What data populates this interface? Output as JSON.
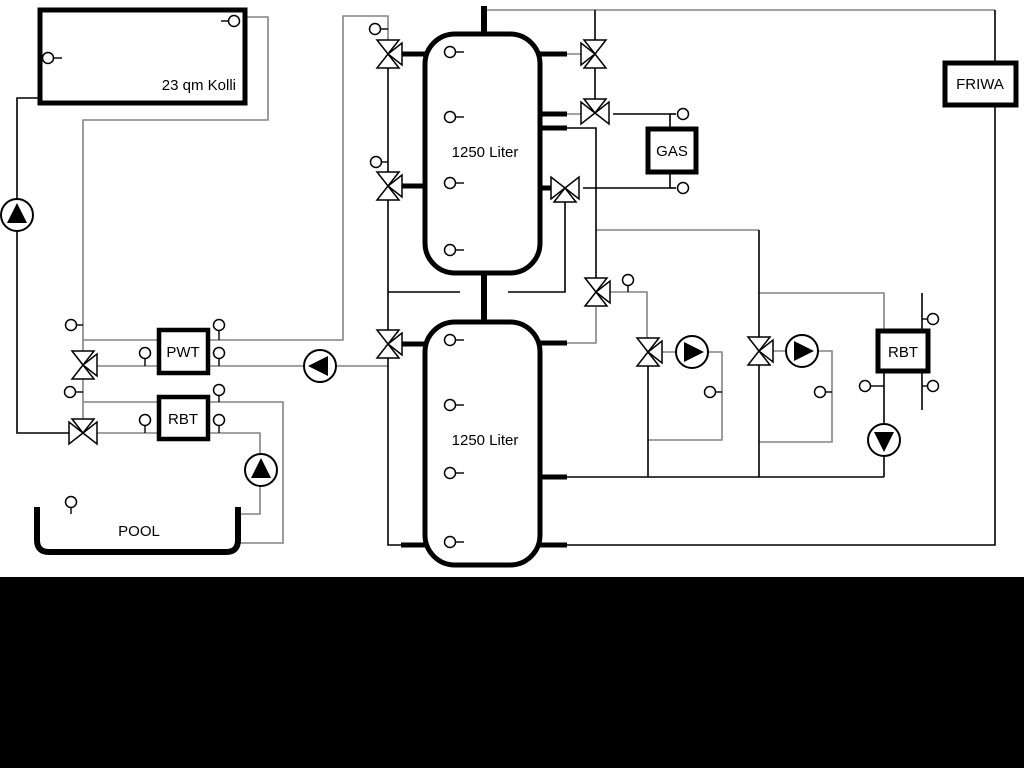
{
  "diagram": {
    "labels": {
      "collector": "23 qm Kolli",
      "tank_top": "1250 Liter",
      "tank_bottom": "1250 Liter",
      "gas": "GAS",
      "friwa": "FRIWA",
      "pwt": "PWT",
      "rbt_left": "RBT",
      "rbt_right": "RBT",
      "pool": "POOL"
    },
    "colors": {
      "background": "#ffffff",
      "line_black": "#000000",
      "line_gray": "#848484",
      "bottom_bar": "#000000"
    }
  }
}
